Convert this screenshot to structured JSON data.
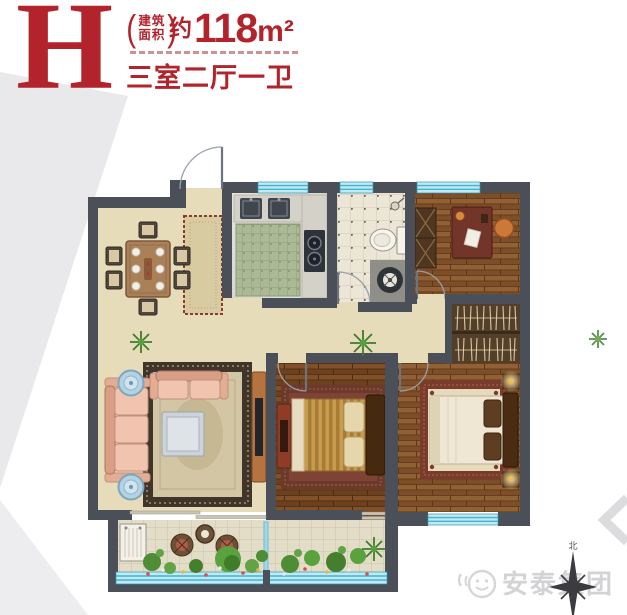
{
  "header": {
    "plan_letter": "H",
    "area_label": {
      "open": "(",
      "line1": "建筑",
      "line2": "面积",
      "close": ")"
    },
    "area_prefix": "约",
    "area_value": "118",
    "area_unit": "m²",
    "layout_text": "三室二厅一卫",
    "accent_color": "#b3232b"
  },
  "floorplan": {
    "colors": {
      "wall": "#4b4f58",
      "floor_beige": "#e7dcba",
      "window_glass": "#bfe9f3",
      "window_stripe": "#45b3cf",
      "wood_floor": "#84572f",
      "bath_tile": "#ebe6d6",
      "kitchen_marble": "#dfddd5",
      "greenery": "#5a9440"
    },
    "icons": [
      "entry-door-icon",
      "window-icon",
      "dining-set-icon",
      "runner-rug-icon",
      "kitchen-sink-icon",
      "stove-icon",
      "toilet-icon",
      "shower-icon",
      "floor-drain-icon",
      "desk-icon",
      "office-chair-icon",
      "bookshelf-icon",
      "wardrobe-icon",
      "sofa-icon",
      "coffee-table-icon",
      "side-table-icon",
      "tv-cabinet-icon",
      "double-bed-icon",
      "nightstand-lamp-icon",
      "plant-icon",
      "balcony-table-icon",
      "balcony-chair-icon",
      "washing-machine-icon",
      "compass-icon",
      "company-logo-icon"
    ]
  },
  "compass": {
    "north_label": "北"
  },
  "watermark": {
    "company_name": "安泰集团"
  }
}
